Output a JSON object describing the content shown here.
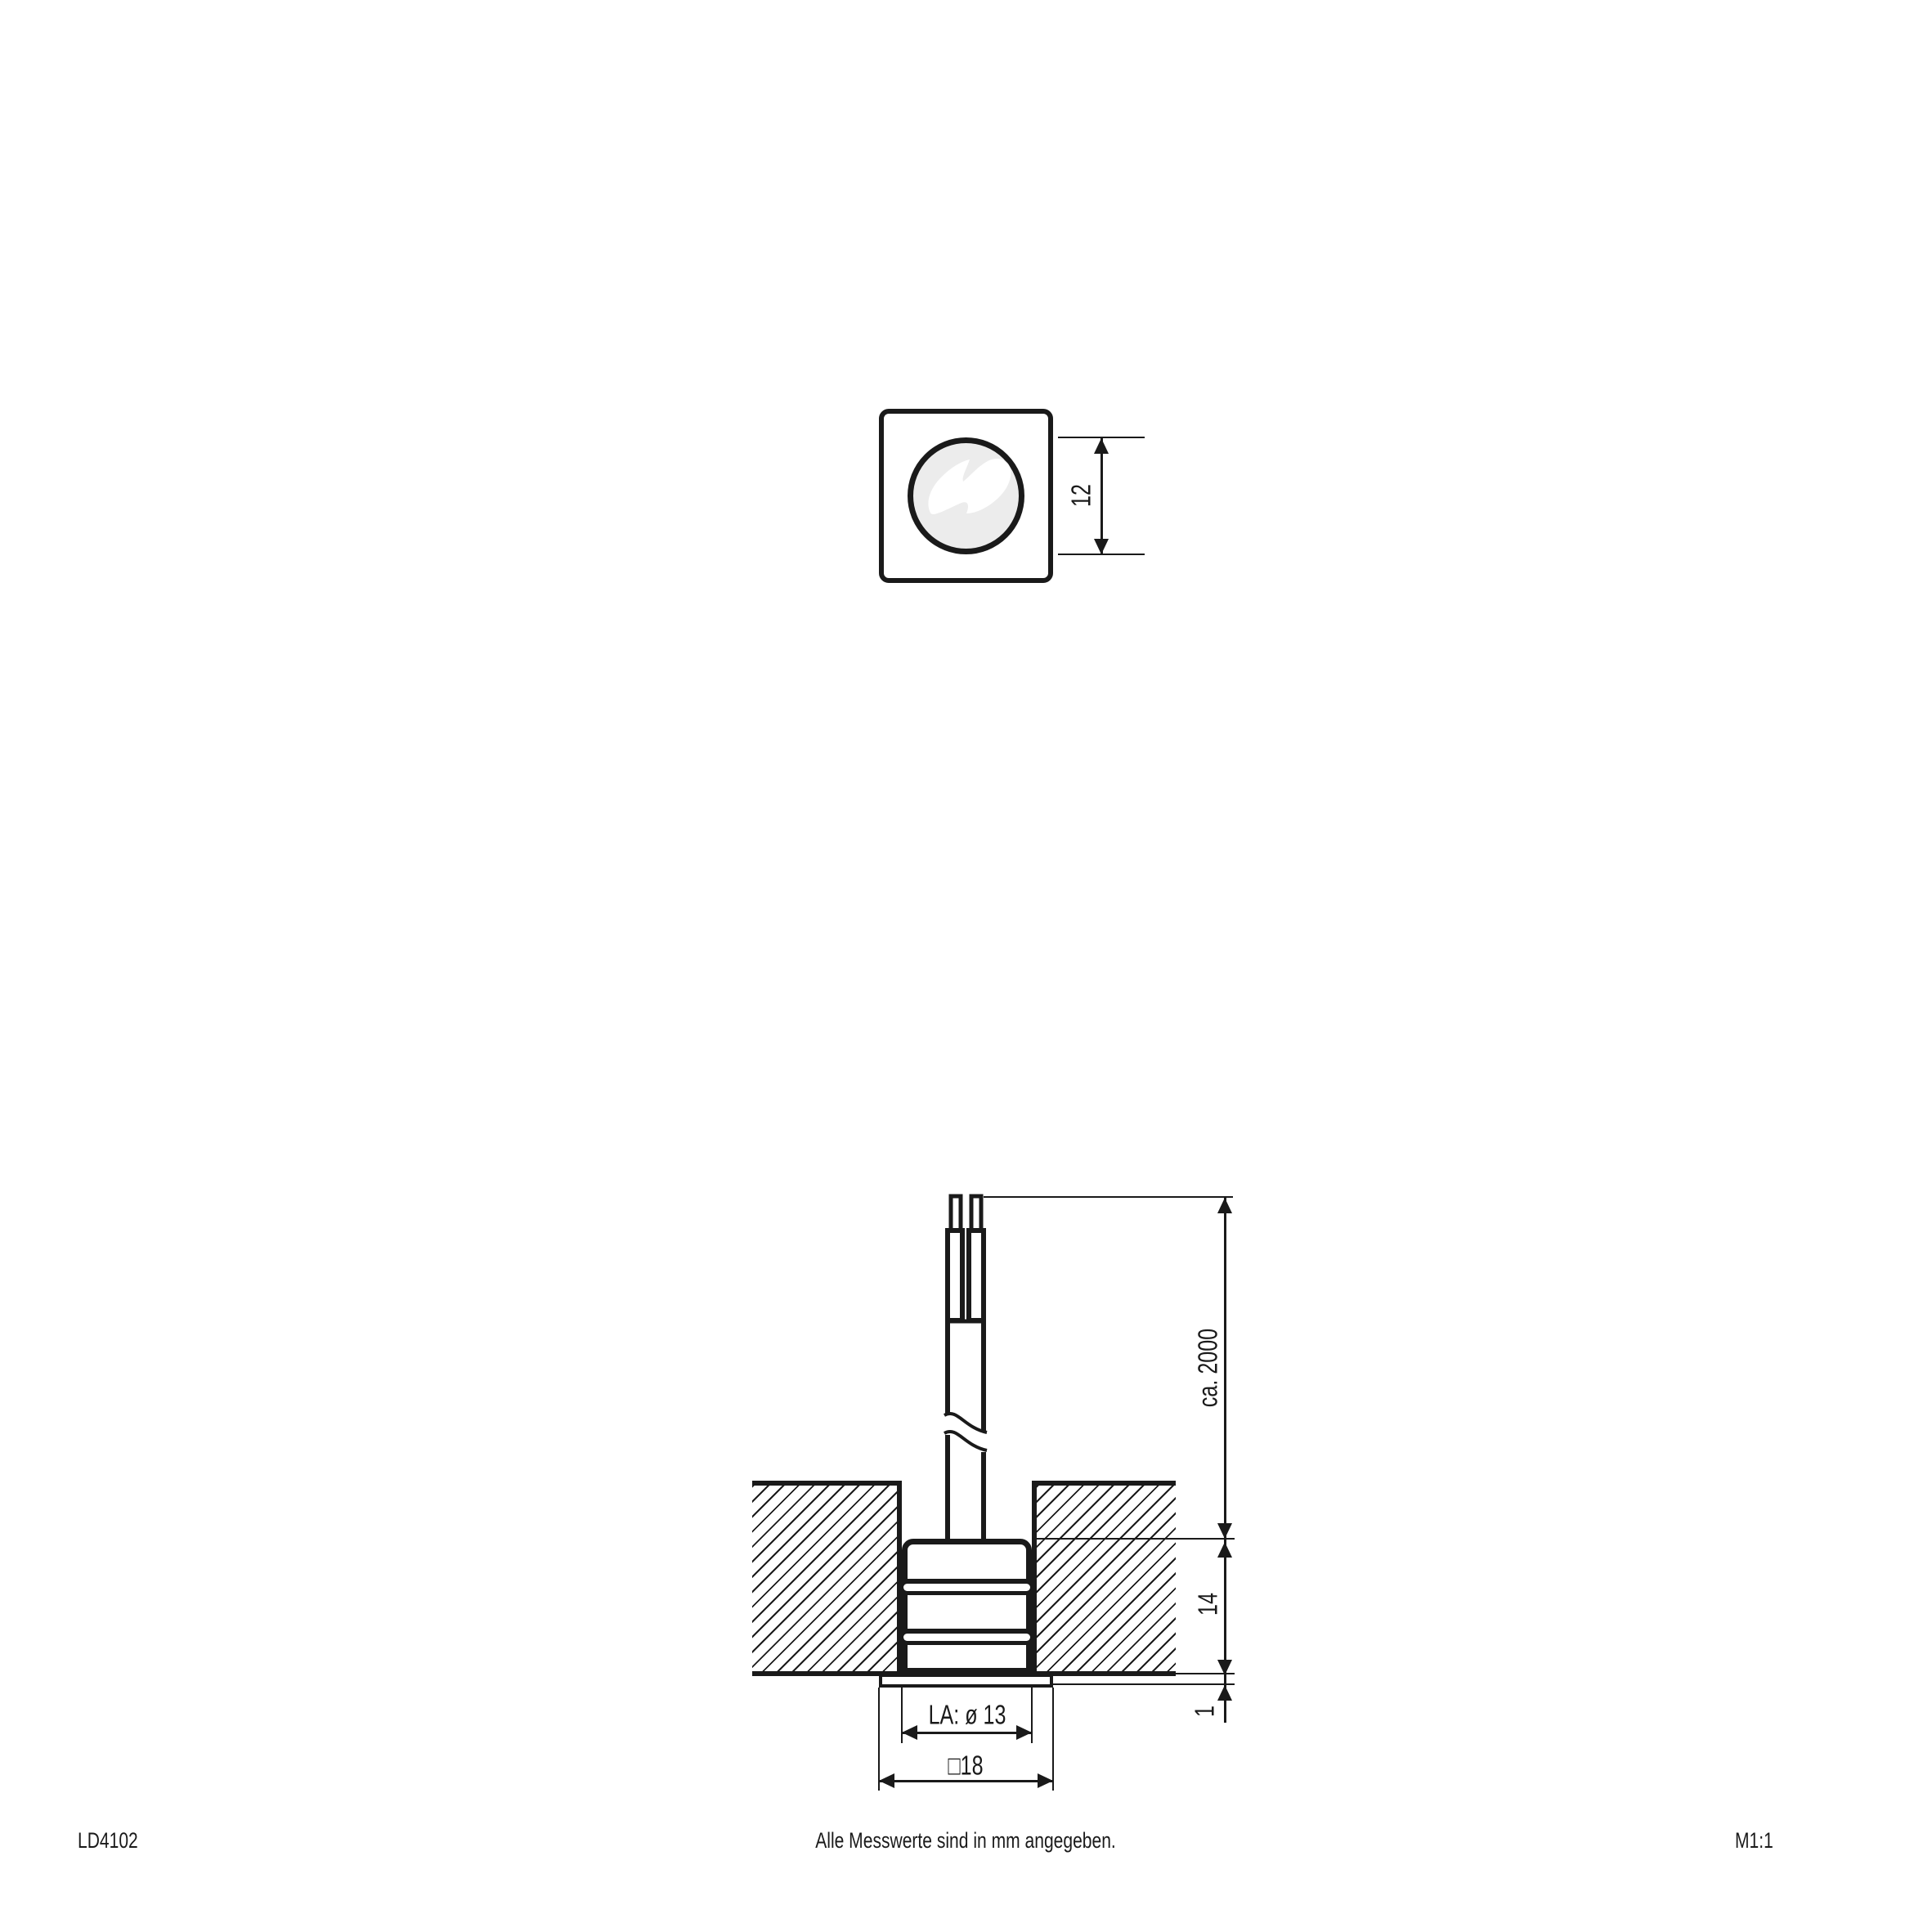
{
  "drawing": {
    "model": "LD4102",
    "note": "Alle Messwerte sind in mm angegeben.",
    "scale": "M1:1",
    "front_view": {
      "lens_diameter": "12"
    },
    "section_view": {
      "cable_length": "ca. 2000",
      "recess_depth": "14",
      "flange_thickness": "1",
      "cutout": "LA: ø 13",
      "outer_size": "□18"
    },
    "colors": {
      "ink": "#1a1a1a",
      "lens_fill": "#ececec",
      "background": "#ffffff"
    }
  }
}
